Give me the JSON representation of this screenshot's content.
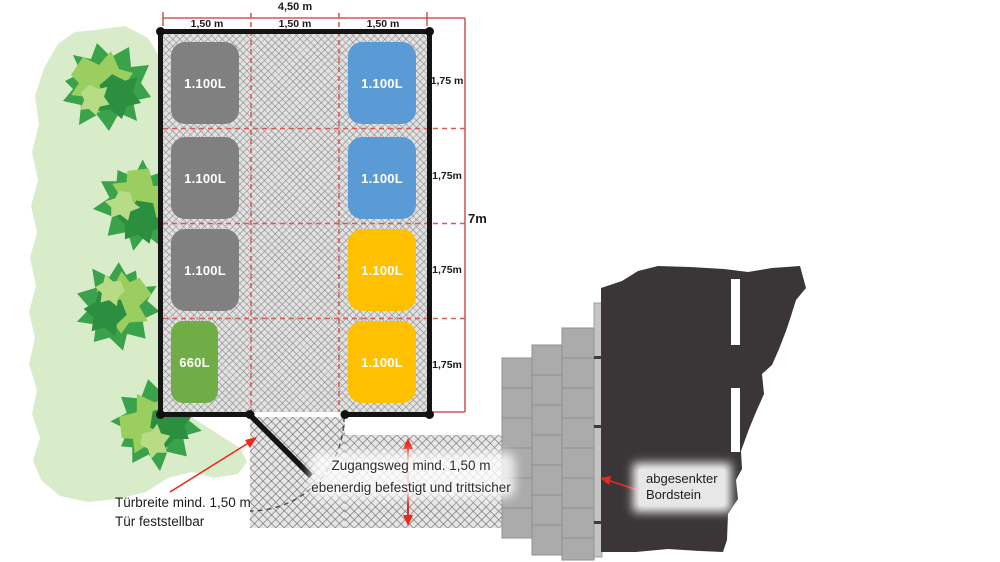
{
  "colors": {
    "container_gray": "#808080",
    "container_blue": "#5b9bd5",
    "container_yellow": "#ffc000",
    "container_green": "#70ad47",
    "road": "#3a3637",
    "road_marking": "#ffffff",
    "brick": "#ababab",
    "curb": "#c4c4c4",
    "vegetation_light": "#d9ecca",
    "bush_base": "#3aa24b",
    "bush_dark": "#2c8f3f",
    "bush_light": "#9ace5f",
    "bush_pale": "#b8dc85",
    "dimension_red": "#c23b36",
    "arrow_red": "#e8291c"
  },
  "dimensions": {
    "width_total": "4,50 m",
    "width_segments": [
      "1,50 m",
      "1,50 m",
      "1,50 m"
    ],
    "height_total": "7m",
    "height_segments": [
      "1,75 m",
      "1,75m",
      "1,75m",
      "1,75m"
    ]
  },
  "containers": {
    "left_column": [
      {
        "label": "1.100L",
        "type": "gray"
      },
      {
        "label": "1.100L",
        "type": "gray"
      },
      {
        "label": "1.100L",
        "type": "gray"
      },
      {
        "label": "660L",
        "type": "green"
      }
    ],
    "right_column": [
      {
        "label": "1.100L",
        "type": "blue"
      },
      {
        "label": "1.100L",
        "type": "blue"
      },
      {
        "label": "1.100L",
        "type": "yellow"
      },
      {
        "label": "1.100L",
        "type": "yellow"
      }
    ]
  },
  "annotations": {
    "door_line1": "Türbreite mind. 1,50 m",
    "door_line2": "Tür feststellbar",
    "path_line1": "Zugangsweg mind. 1,50 m",
    "path_line2": "ebenerdig befestigt und trittsicher",
    "curb_line1": "abgesenkter",
    "curb_line2": "Bordstein"
  }
}
